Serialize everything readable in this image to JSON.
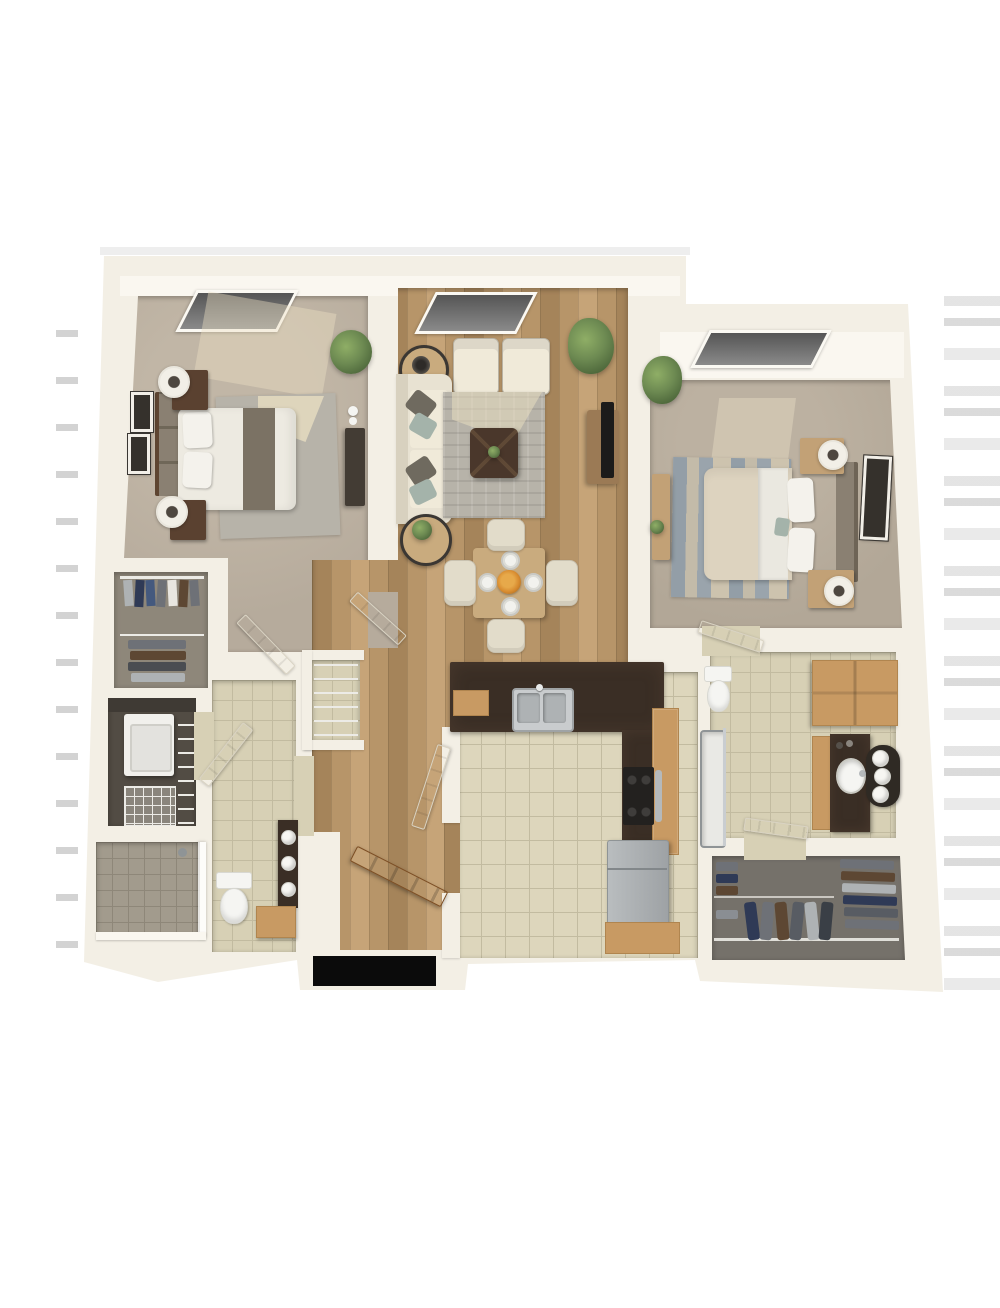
{
  "image_type": "3d-rendered-floor-plan",
  "scene": "Top-down 3D dollhouse rendering of a two-bedroom, two-bathroom apartment with open living/dining area, galley kitchen, two walk-in closets, laundry nook and entry hall. No text or UI controls are rendered in the image.",
  "rooms": [
    {
      "name": "bedroom-left",
      "floor": "carpet",
      "furniture": [
        "queen bed with gray runner",
        "upholstered headboard",
        "two dark wood nightstands",
        "two drum lamps",
        "two wall frames",
        "area rug",
        "tall dresser",
        "corner plant",
        "window"
      ]
    },
    {
      "name": "living-dining",
      "floor": "wood plank",
      "furniture": [
        "cream sofa with gray and sage pillows",
        "two accent armchairs",
        "two round side tables",
        "gray area rug",
        "dark square coffee table",
        "media console with TV",
        "tall potted plant",
        "square dining table with four place settings and orange centerpiece",
        "four dining chairs",
        "window"
      ]
    },
    {
      "name": "bedroom-right",
      "floor": "carpet",
      "furniture": [
        "queen bed with beige duvet",
        "headboard",
        "two light wood nightstands with lamps",
        "striped blue area rug",
        "dresser with plant",
        "wall frame",
        "corner plant",
        "window"
      ]
    },
    {
      "name": "walk-in-closet-left",
      "floor": "carpet",
      "furniture": [
        "wire shelving",
        "hanging shirts",
        "folded clothing stacks"
      ]
    },
    {
      "name": "laundry-nook",
      "floor": "dark",
      "furniture": [
        "washer",
        "wire shelf rack"
      ]
    },
    {
      "name": "bathroom-left",
      "floor": "tile",
      "furniture": [
        "walk-in tiled shower with glass panel",
        "toilet",
        "wood vanity with dark counter and rolled towels",
        "wire linen niche"
      ]
    },
    {
      "name": "kitchen",
      "floor": "tile",
      "furniture": [
        "L-shaped dark granite counter",
        "double stainless sink",
        "black range with steel handle",
        "stainless refrigerator",
        "oak cabinets"
      ]
    },
    {
      "name": "bathroom-right",
      "floor": "tile",
      "furniture": [
        "toilet",
        "oak linen cabinet",
        "vanity with oval sink and towel caddy",
        "bathtub with glass screen"
      ]
    },
    {
      "name": "walk-in-closet-right",
      "floor": "carpet",
      "furniture": [
        "wire rails",
        "hanging jackets",
        "folded clothing stacks"
      ]
    },
    {
      "name": "entry-hall",
      "floor": "wood plank",
      "furniture": [
        "open wooden front door",
        "dark exterior doorway gap"
      ]
    }
  ],
  "colors": {
    "page_bg": "#ffffff",
    "wall": "#f3efe5",
    "wall_bright": "#faf7f0",
    "wall_shadow": "#d8d1c0",
    "carpet_bed_left": "#b6ab9c",
    "carpet_bed_right": "#b2a797",
    "carpet_closet": "#8e877a",
    "carpet_closet_right": "#75716a",
    "wood": "#b79569",
    "wood_dark": "#a5845a",
    "wood_light": "#c6a478",
    "tile_kitchen": "#ddd6bc",
    "tile_bath": "#d7d0b5",
    "tile_grout": "#c2bba0",
    "tile_shower": "#a29b8d",
    "tile_shower_grout": "#8e8779",
    "counter_dark": "#3a2e25",
    "cabinet_wood": "#c89a63",
    "cabinet_wood_dark": "#b0854f",
    "sofa_cream": "#e8e2d2",
    "cushion_cream": "#f0ead9",
    "pillow_gray": "#6f6a5f",
    "pillow_teal": "#a4b3aa",
    "rug_gray": "#b7b3a9",
    "rug_highlight": "#e7ddc0",
    "rug_blue": "#939ea7",
    "rug_beige": "#cdc3ae",
    "bed_white": "#edeae1",
    "bed_runner": "#7b7264",
    "bed_beige": "#ddd3bf",
    "pillow_white": "#f4f2ec",
    "headboard_dark": "#5e4531",
    "headboard_gray": "#8a8072",
    "nightstand_dark": "#5a4130",
    "nightstand_light": "#c2a176",
    "lamp_shade": "#f2efe7",
    "lamp_dark": "#4e4740",
    "tv_black": "#1c1b1a",
    "console_wood": "#9b7a55",
    "table_wood": "#c9ab7e",
    "chair_cream": "#e2dcca",
    "plant_green": "#6d8a52",
    "plant_green_dark": "#4c663a",
    "plant_pot": "#8a8477",
    "door_white": "#f8f5ee",
    "door_white_edge": "#d9d3c3",
    "door_wood": "#b9834f",
    "door_wood_dark": "#935f31",
    "appliance_white": "#f1f0ec",
    "steel": "#b5b9bb",
    "steel_dark": "#8f9496",
    "stove_black": "#23211f",
    "porcelain": "#f5f5f2",
    "towel_white": "#f7f6f2",
    "tray_dark": "#2f2a24",
    "wire_shelf": "#ecebe6",
    "clothes_navy": "#2f3a56",
    "clothes_blue": "#44597e",
    "clothes_gray": "#6e7177",
    "clothes_brown": "#5d4733",
    "clothes_light": "#aeb2b4",
    "accent_flower": "#d78a2e",
    "frame_dark": "#35312c",
    "doorway_black": "#0b0b0b",
    "laundry_dark": "#524c44",
    "dresser_dark": "#433c34"
  }
}
